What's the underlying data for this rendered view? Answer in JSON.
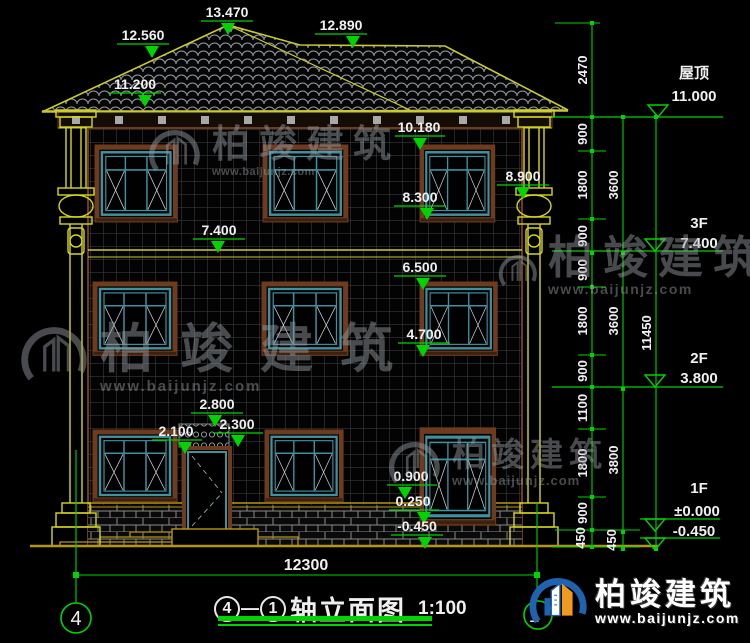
{
  "colors": {
    "dim_green": "#00d400",
    "roof_yellow": "#c9c932",
    "column_yellow": "#d8d81e",
    "frame_brown": "#6e3b1e",
    "frame_teal": "#4090a0",
    "ground_yellow": "#b8960c",
    "text_white": "#f0f0f0",
    "watermark_gray": "#969ca2",
    "logo_blue": "#1e62b0",
    "logo_orange": "#f29a1d"
  },
  "facade_levels": [
    {
      "value": "13.470"
    },
    {
      "value": "12.560"
    },
    {
      "value": "12.890"
    },
    {
      "value": "11.200"
    },
    {
      "value": "10.180"
    },
    {
      "value": "8.900"
    },
    {
      "value": "8.300"
    },
    {
      "value": "7.400"
    },
    {
      "value": "6.500"
    },
    {
      "value": "4.700"
    },
    {
      "value": "2.800"
    },
    {
      "value": "2.300"
    },
    {
      "value": "2.100"
    },
    {
      "value": "0.900"
    },
    {
      "value": "0.250"
    },
    {
      "value": "-0.450"
    }
  ],
  "right_levels": [
    {
      "label": "屋顶",
      "value": "11.000"
    },
    {
      "label": "3F",
      "value": "7.400"
    },
    {
      "label": "2F",
      "value": "3.800"
    },
    {
      "label": "1F",
      "value": "±0.000"
    },
    {
      "label": "",
      "value": "-0.450"
    }
  ],
  "chains": {
    "inner": [
      "2470",
      "900",
      "1800",
      "900",
      "900",
      "1800",
      "900",
      "1100",
      "1800",
      "900",
      "450"
    ],
    "middle": [
      "3600",
      "3600",
      "3800",
      "450"
    ],
    "outer": [
      "11450"
    ]
  },
  "bottom_dimension": "12300",
  "axis_bubbles": {
    "left": "4",
    "right": "1"
  },
  "title": {
    "bubble_start": "4",
    "separator": "—",
    "bubble_end": "1",
    "text": "轴立面图",
    "scale": "1:100"
  },
  "watermark": {
    "brand": "柏竣建筑",
    "url": "www.baijunjz.com"
  },
  "logo": {
    "brand": "柏竣建筑",
    "url": "www.baijunjz.com"
  }
}
